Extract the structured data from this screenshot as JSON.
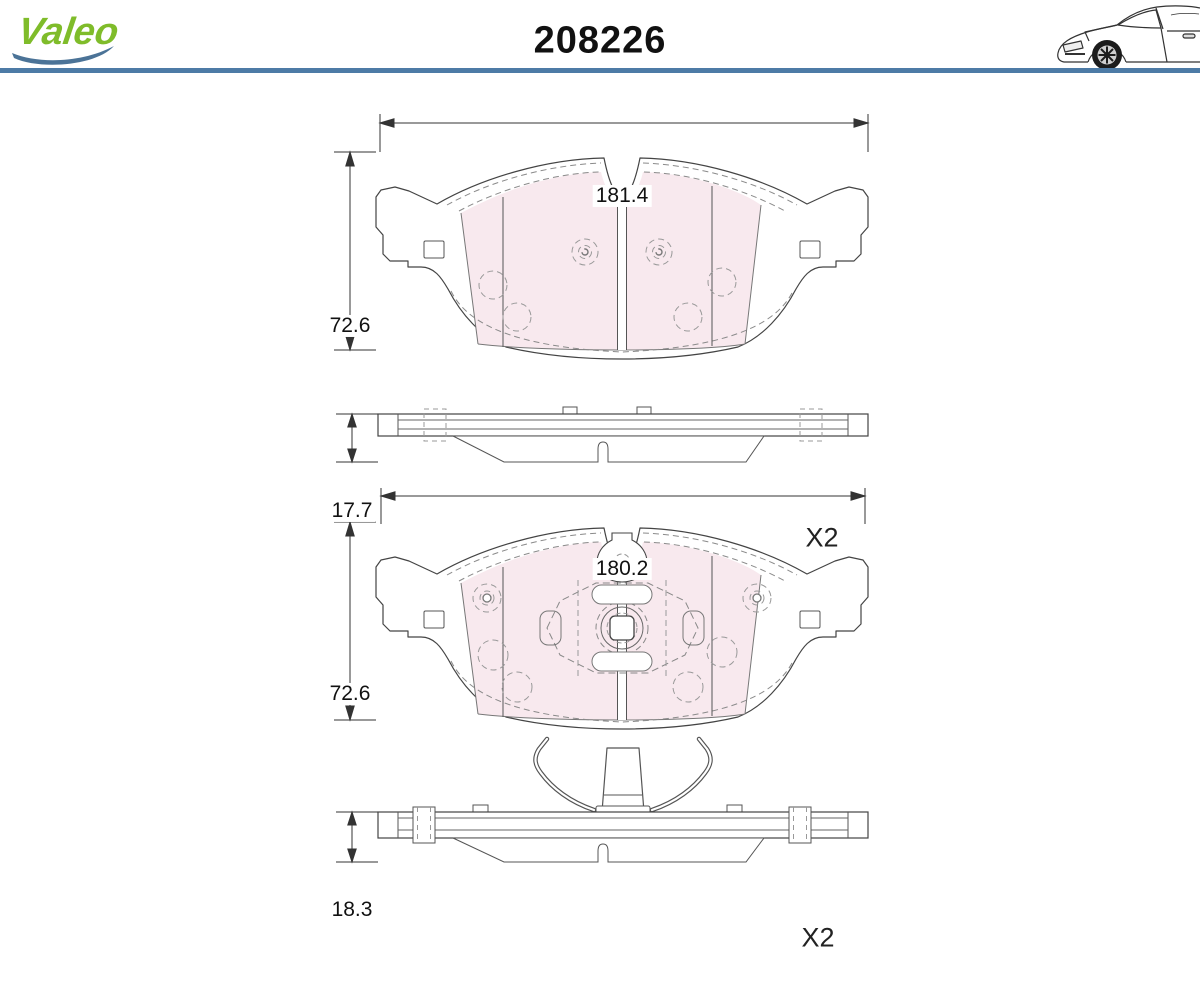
{
  "header": {
    "brand_name": "Valeo",
    "part_number": "208226",
    "brand_color": "#7fbc2a",
    "swoosh_color": "#4b7397",
    "rule_color": "#4d7ba6",
    "car_icon": "car-front-half-line-art"
  },
  "drawings": {
    "pad1_front": {
      "width": "181.4",
      "height": "72.6"
    },
    "pad1_side": {
      "thickness": "17.7",
      "quantity": "X2"
    },
    "pad2_front": {
      "width": "180.2",
      "height": "72.6"
    },
    "pad2_side": {
      "thickness": "18.3",
      "quantity": "X2"
    }
  },
  "colors": {
    "friction_fill": "#f8e9ee",
    "outline": "#444444",
    "dashed_detail": "#999999"
  }
}
